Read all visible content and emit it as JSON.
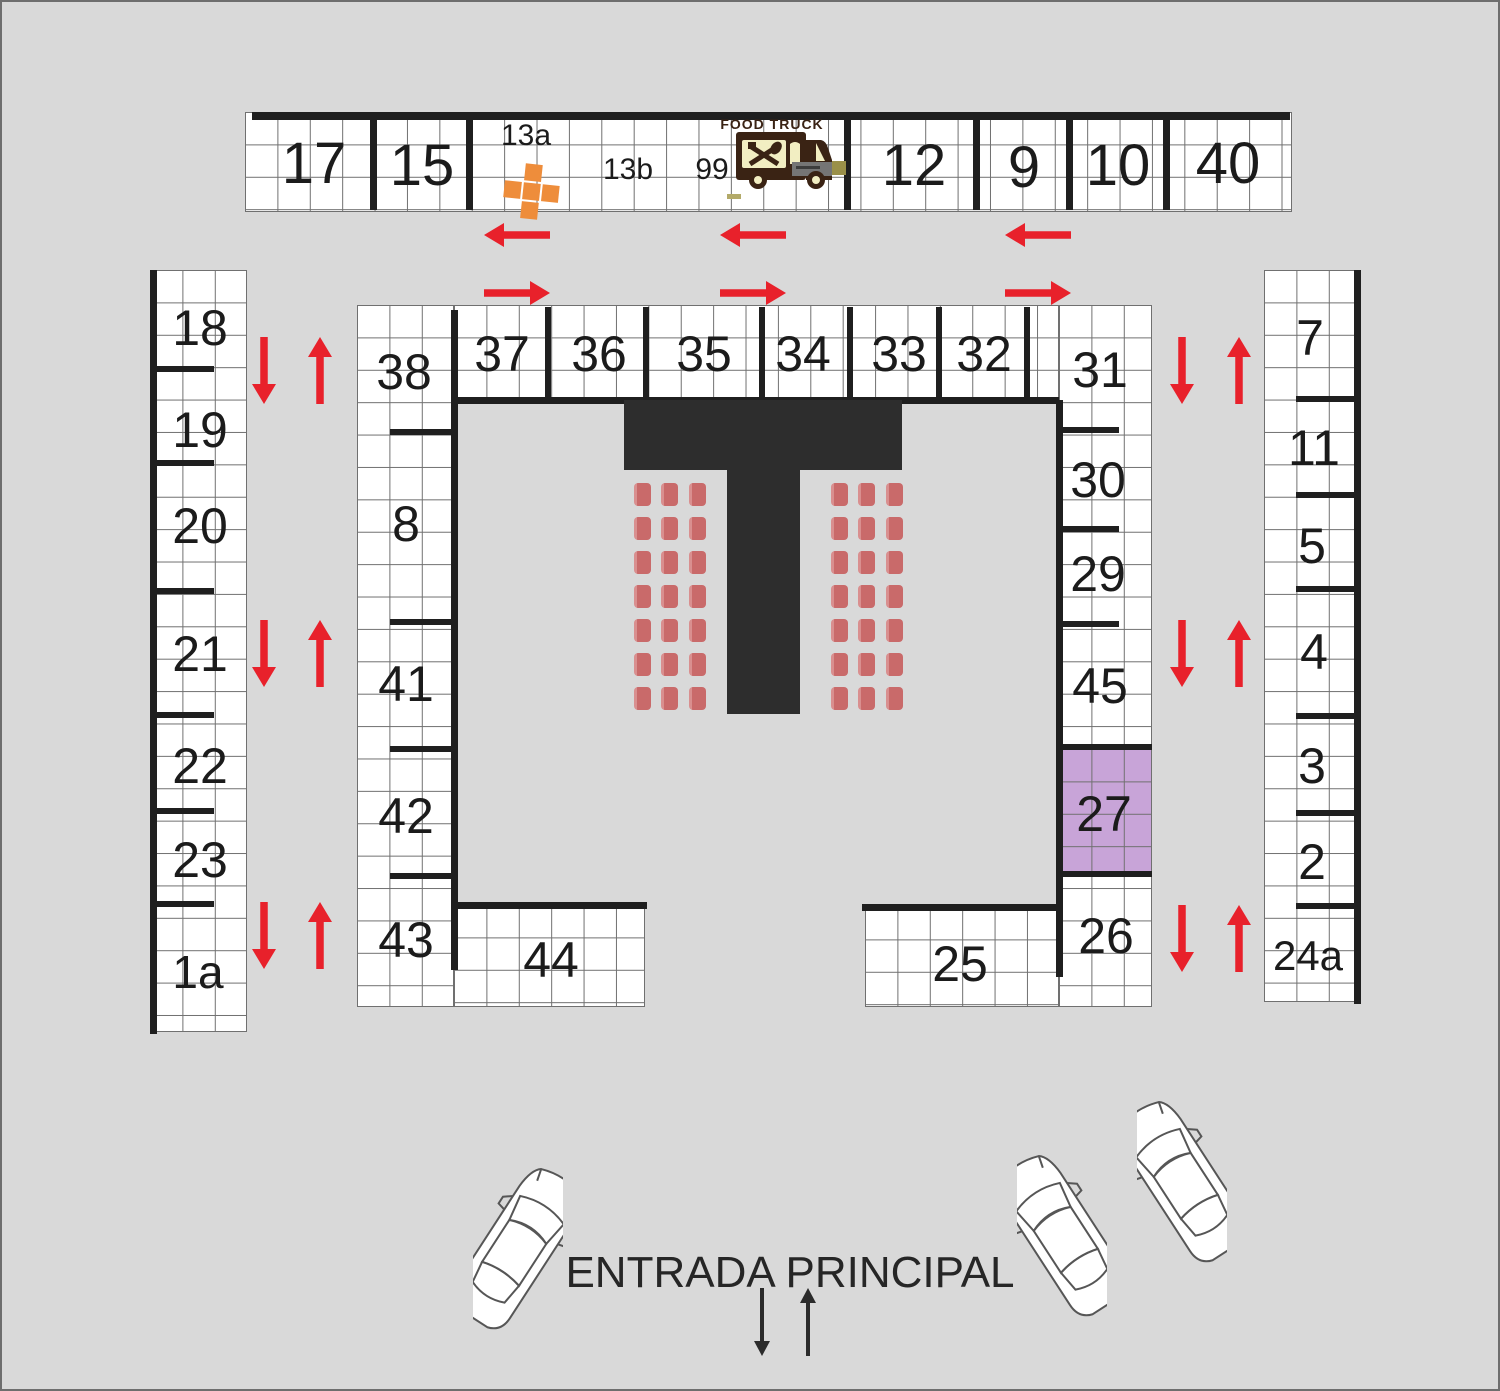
{
  "canvas": {
    "w": 1500,
    "h": 1391,
    "bg": "#d9d9d9"
  },
  "colors": {
    "background": "#d9d9d9",
    "wall": "#1f1f1f",
    "grid_line": "#707070",
    "stage": "#2d2d2d",
    "chair": "#c96a6a",
    "chair_highlight": "#d98f8f",
    "stall_highlight": "#c8a4d8",
    "arrow_red": "#e8212b",
    "arrow_black": "#2b2b2b",
    "orange": "#ee8d3b",
    "truck_brown": "#3a2314",
    "truck_cream": "#f2eec2",
    "truck_gray": "#757575",
    "plate_tan": "#9a9049",
    "label": "#1b1b1b",
    "car_line": "#565656"
  },
  "blocks": [
    {
      "name": "stalls-top-row",
      "x": 243,
      "y": 110,
      "w": 1047,
      "h": 100
    },
    {
      "name": "stalls-left-column",
      "x": 148,
      "y": 268,
      "w": 97,
      "h": 762
    },
    {
      "name": "stalls-left-arm",
      "x": 355,
      "y": 303,
      "w": 97,
      "h": 702
    },
    {
      "name": "stalls-top-inner-row",
      "x": 452,
      "y": 303,
      "w": 605,
      "h": 95
    },
    {
      "name": "stalls-bottom-left-band",
      "x": 452,
      "y": 903,
      "w": 191,
      "h": 102
    },
    {
      "name": "stalls-right-inner-column",
      "x": 1057,
      "y": 303,
      "w": 93,
      "h": 702
    },
    {
      "name": "stalls-bottom-right-band",
      "x": 863,
      "y": 905,
      "w": 194,
      "h": 100
    },
    {
      "name": "stalls-right-column",
      "x": 1262,
      "y": 268,
      "w": 96,
      "h": 732
    }
  ],
  "highlight_block": {
    "name": "stall-27-highlight",
    "x": 1057,
    "y": 747,
    "w": 93,
    "h": 126,
    "fill": "#c8a4d8"
  },
  "walls": [
    {
      "x": 250,
      "y": 110,
      "w": 1038,
      "h": 8
    },
    {
      "x": 368,
      "y": 112,
      "w": 7,
      "h": 96
    },
    {
      "x": 464,
      "y": 112,
      "w": 7,
      "h": 96
    },
    {
      "x": 842,
      "y": 112,
      "w": 7,
      "h": 96
    },
    {
      "x": 971,
      "y": 112,
      "w": 7,
      "h": 96
    },
    {
      "x": 1064,
      "y": 112,
      "w": 7,
      "h": 96
    },
    {
      "x": 1161,
      "y": 112,
      "w": 7,
      "h": 96
    },
    {
      "x": 148,
      "y": 268,
      "w": 7,
      "h": 764
    },
    {
      "x": 152,
      "y": 364,
      "w": 60,
      "h": 6
    },
    {
      "x": 152,
      "y": 458,
      "w": 60,
      "h": 6
    },
    {
      "x": 152,
      "y": 586,
      "w": 60,
      "h": 6
    },
    {
      "x": 152,
      "y": 710,
      "w": 60,
      "h": 6
    },
    {
      "x": 152,
      "y": 806,
      "w": 60,
      "h": 6
    },
    {
      "x": 152,
      "y": 899,
      "w": 60,
      "h": 6
    },
    {
      "x": 388,
      "y": 427,
      "w": 64,
      "h": 6
    },
    {
      "x": 388,
      "y": 617,
      "w": 64,
      "h": 6
    },
    {
      "x": 388,
      "y": 744,
      "w": 64,
      "h": 6
    },
    {
      "x": 388,
      "y": 871,
      "w": 64,
      "h": 6
    },
    {
      "x": 543,
      "y": 305,
      "w": 6,
      "h": 93
    },
    {
      "x": 641,
      "y": 305,
      "w": 6,
      "h": 93
    },
    {
      "x": 757,
      "y": 305,
      "w": 6,
      "h": 93
    },
    {
      "x": 845,
      "y": 305,
      "w": 6,
      "h": 93
    },
    {
      "x": 934,
      "y": 305,
      "w": 6,
      "h": 93
    },
    {
      "x": 1022,
      "y": 305,
      "w": 6,
      "h": 93
    },
    {
      "x": 449,
      "y": 308,
      "w": 7,
      "h": 660
    },
    {
      "x": 452,
      "y": 395,
      "w": 605,
      "h": 7
    },
    {
      "x": 1054,
      "y": 398,
      "w": 7,
      "h": 577
    },
    {
      "x": 449,
      "y": 900,
      "w": 196,
      "h": 7
    },
    {
      "x": 860,
      "y": 902,
      "w": 197,
      "h": 7
    },
    {
      "x": 1059,
      "y": 425,
      "w": 58,
      "h": 6
    },
    {
      "x": 1059,
      "y": 524,
      "w": 58,
      "h": 6
    },
    {
      "x": 1059,
      "y": 619,
      "w": 58,
      "h": 6
    },
    {
      "x": 1057,
      "y": 742,
      "w": 93,
      "h": 6
    },
    {
      "x": 1057,
      "y": 869,
      "w": 93,
      "h": 6
    },
    {
      "x": 1352,
      "y": 268,
      "w": 7,
      "h": 734
    },
    {
      "x": 1294,
      "y": 394,
      "w": 60,
      "h": 6
    },
    {
      "x": 1294,
      "y": 490,
      "w": 60,
      "h": 6
    },
    {
      "x": 1294,
      "y": 584,
      "w": 60,
      "h": 6
    },
    {
      "x": 1294,
      "y": 711,
      "w": 60,
      "h": 6
    },
    {
      "x": 1294,
      "y": 808,
      "w": 60,
      "h": 6
    },
    {
      "x": 1294,
      "y": 901,
      "w": 60,
      "h": 6
    }
  ],
  "stage": [
    {
      "x": 622,
      "y": 398,
      "w": 278,
      "h": 70
    },
    {
      "x": 725,
      "y": 466,
      "w": 73,
      "h": 246
    }
  ],
  "chairs": {
    "rows": 7,
    "cols": 3,
    "w": 17,
    "h": 23,
    "dx": 27.4,
    "dy": 34,
    "blocks": [
      {
        "x": 632,
        "y": 481
      },
      {
        "x": 829,
        "y": 481
      }
    ]
  },
  "stalls": [
    {
      "t": "17",
      "x": 312,
      "y": 162,
      "fs": 58
    },
    {
      "t": "15",
      "x": 420,
      "y": 164,
      "fs": 58
    },
    {
      "t": "13a",
      "x": 524,
      "y": 134,
      "fs": 30
    },
    {
      "t": "13b",
      "x": 626,
      "y": 168,
      "fs": 30
    },
    {
      "t": "99",
      "x": 710,
      "y": 168,
      "fs": 30
    },
    {
      "t": "12",
      "x": 912,
      "y": 164,
      "fs": 58
    },
    {
      "t": "9",
      "x": 1022,
      "y": 166,
      "fs": 58
    },
    {
      "t": "10",
      "x": 1116,
      "y": 164,
      "fs": 58
    },
    {
      "t": "40",
      "x": 1226,
      "y": 162,
      "fs": 58
    },
    {
      "t": "18",
      "x": 198,
      "y": 326,
      "fs": 50
    },
    {
      "t": "19",
      "x": 198,
      "y": 428,
      "fs": 50
    },
    {
      "t": "20",
      "x": 198,
      "y": 524,
      "fs": 50
    },
    {
      "t": "21",
      "x": 198,
      "y": 652,
      "fs": 50
    },
    {
      "t": "22",
      "x": 198,
      "y": 764,
      "fs": 50
    },
    {
      "t": "23",
      "x": 198,
      "y": 858,
      "fs": 50
    },
    {
      "t": "1a",
      "x": 196,
      "y": 970,
      "fs": 46
    },
    {
      "t": "38",
      "x": 402,
      "y": 370,
      "fs": 50
    },
    {
      "t": "8",
      "x": 404,
      "y": 522,
      "fs": 50
    },
    {
      "t": "41",
      "x": 404,
      "y": 682,
      "fs": 50
    },
    {
      "t": "42",
      "x": 404,
      "y": 814,
      "fs": 50
    },
    {
      "t": "43",
      "x": 404,
      "y": 938,
      "fs": 50
    },
    {
      "t": "37",
      "x": 500,
      "y": 352,
      "fs": 50
    },
    {
      "t": "36",
      "x": 597,
      "y": 352,
      "fs": 50
    },
    {
      "t": "35",
      "x": 702,
      "y": 352,
      "fs": 50
    },
    {
      "t": "34",
      "x": 801,
      "y": 352,
      "fs": 50
    },
    {
      "t": "33",
      "x": 897,
      "y": 352,
      "fs": 50
    },
    {
      "t": "32",
      "x": 982,
      "y": 352,
      "fs": 50
    },
    {
      "t": "31",
      "x": 1098,
      "y": 368,
      "fs": 50
    },
    {
      "t": "30",
      "x": 1096,
      "y": 478,
      "fs": 50
    },
    {
      "t": "29",
      "x": 1096,
      "y": 572,
      "fs": 50
    },
    {
      "t": "45",
      "x": 1098,
      "y": 684,
      "fs": 50
    },
    {
      "t": "27",
      "x": 1102,
      "y": 812,
      "fs": 50
    },
    {
      "t": "26",
      "x": 1104,
      "y": 934,
      "fs": 50
    },
    {
      "t": "44",
      "x": 549,
      "y": 958,
      "fs": 50
    },
    {
      "t": "25",
      "x": 958,
      "y": 962,
      "fs": 50
    },
    {
      "t": "7",
      "x": 1308,
      "y": 336,
      "fs": 50
    },
    {
      "t": "11",
      "x": 1312,
      "y": 446,
      "fs": 50
    },
    {
      "t": "5",
      "x": 1310,
      "y": 544,
      "fs": 50
    },
    {
      "t": "4",
      "x": 1312,
      "y": 650,
      "fs": 50
    },
    {
      "t": "3",
      "x": 1310,
      "y": 764,
      "fs": 50
    },
    {
      "t": "2",
      "x": 1310,
      "y": 860,
      "fs": 50
    },
    {
      "t": "24a",
      "x": 1306,
      "y": 954,
      "fs": 42
    }
  ],
  "arrows_red": [
    {
      "x": 482,
      "y": 233,
      "len": 66,
      "dir": "left"
    },
    {
      "x": 718,
      "y": 233,
      "len": 66,
      "dir": "left"
    },
    {
      "x": 1003,
      "y": 233,
      "len": 66,
      "dir": "left"
    },
    {
      "x": 482,
      "y": 291,
      "len": 66,
      "dir": "right"
    },
    {
      "x": 718,
      "y": 291,
      "len": 66,
      "dir": "right"
    },
    {
      "x": 1003,
      "y": 291,
      "len": 66,
      "dir": "right"
    },
    {
      "x": 262,
      "y": 335,
      "len": 67,
      "dir": "down"
    },
    {
      "x": 318,
      "y": 335,
      "len": 67,
      "dir": "up"
    },
    {
      "x": 262,
      "y": 618,
      "len": 67,
      "dir": "down"
    },
    {
      "x": 318,
      "y": 618,
      "len": 67,
      "dir": "up"
    },
    {
      "x": 262,
      "y": 900,
      "len": 67,
      "dir": "down"
    },
    {
      "x": 318,
      "y": 900,
      "len": 67,
      "dir": "up"
    },
    {
      "x": 1180,
      "y": 335,
      "len": 67,
      "dir": "down"
    },
    {
      "x": 1237,
      "y": 335,
      "len": 67,
      "dir": "up"
    },
    {
      "x": 1180,
      "y": 618,
      "len": 67,
      "dir": "down"
    },
    {
      "x": 1237,
      "y": 618,
      "len": 67,
      "dir": "up"
    },
    {
      "x": 1180,
      "y": 903,
      "len": 67,
      "dir": "down"
    },
    {
      "x": 1237,
      "y": 903,
      "len": 67,
      "dir": "up"
    }
  ],
  "arrows_black": [
    {
      "x": 760,
      "y": 1286,
      "len": 68,
      "dir": "down"
    },
    {
      "x": 806,
      "y": 1286,
      "len": 68,
      "dir": "up"
    }
  ],
  "entrance": {
    "label": "ENTRADA PRINCIPAL",
    "x": 788,
    "y": 1271,
    "fs": 44
  },
  "food_truck": {
    "label": "FOOD TRUCK",
    "x": 726,
    "y": 112,
    "w": 122,
    "h": 78,
    "label_x": 770,
    "label_y": 118,
    "label_fs": 14
  },
  "cross": {
    "x": 529,
    "y": 189,
    "size": 17,
    "gap": 19,
    "rot": 6
  },
  "marks": [
    {
      "x": 822,
      "y": 159,
      "w": 22,
      "h": 14,
      "color": "#9a9049"
    },
    {
      "x": 725,
      "y": 192,
      "w": 14,
      "h": 5,
      "color": "#b3aa69"
    }
  ],
  "cars": [
    {
      "cx": 516,
      "cy": 1245,
      "rot": 33
    },
    {
      "cx": 1060,
      "cy": 1232,
      "rot": -33
    },
    {
      "cx": 1180,
      "cy": 1178,
      "rot": -33
    }
  ]
}
